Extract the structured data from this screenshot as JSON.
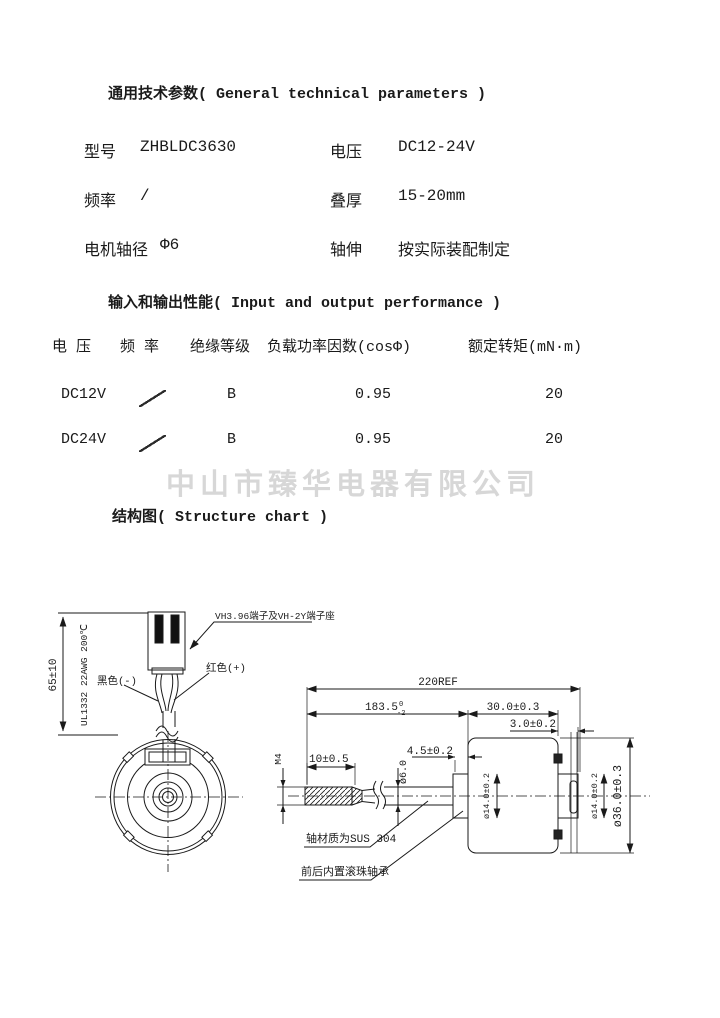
{
  "sections": {
    "general_title": "通用技术参数( General technical parameters )",
    "io_title": "输入和输出性能( Input and output performance )",
    "structure_title": "结构图( Structure chart )"
  },
  "params": {
    "rows": [
      {
        "l1": "型号",
        "v1": "ZHBLDC3630",
        "l2": "电压",
        "v2": "DC12-24V"
      },
      {
        "l1": "频率",
        "v1": "/",
        "l2": "叠厚",
        "v2": "15-20mm"
      },
      {
        "l1": "电机轴径",
        "v1": "Φ6",
        "l2": "轴伸",
        "v2": "按实际装配制定"
      }
    ]
  },
  "io_table": {
    "headers": [
      "电 压",
      "频 率",
      "绝缘等级",
      "负载功率因数(cosΦ)",
      "额定转矩(mN·m)"
    ],
    "rows": [
      {
        "voltage": "DC12V",
        "frequency": "╲",
        "insulation": "B",
        "power_factor": "0.95",
        "torque": "20"
      },
      {
        "voltage": "DC24V",
        "frequency": "╲",
        "insulation": "B",
        "power_factor": "0.95",
        "torque": "20"
      }
    ]
  },
  "watermark": {
    "text": "中山市臻华电器有限公司",
    "color": "#d7d7d7"
  },
  "drawing": {
    "wire_length": "65±10",
    "wire_spec": "UL1332 22AWG 200℃",
    "connector_label": "VH3.96端子及VH-2Y端子座",
    "wire_black": "黑色(-)",
    "wire_red": "红色(+)",
    "overall_length": "220REF",
    "shaft_length": "183.5",
    "shaft_tol_upper": "0",
    "shaft_tol_lower": "-2",
    "body_length": "30.0±0.3",
    "rear_boss_length": "3.0±0.2",
    "front_boss_length": "4.5±0.2",
    "thread_length": "10±0.5",
    "thread_size": "M4",
    "shaft_dia": "ø6.0",
    "front_boss_dia": "ø14.0±0.2",
    "rear_boss_dia": "ø14.0±0.2",
    "body_dia": "ø36.0±0.3",
    "shaft_material": "轴材质为SUS 304",
    "bearing_note": "前后内置滚珠轴承"
  }
}
